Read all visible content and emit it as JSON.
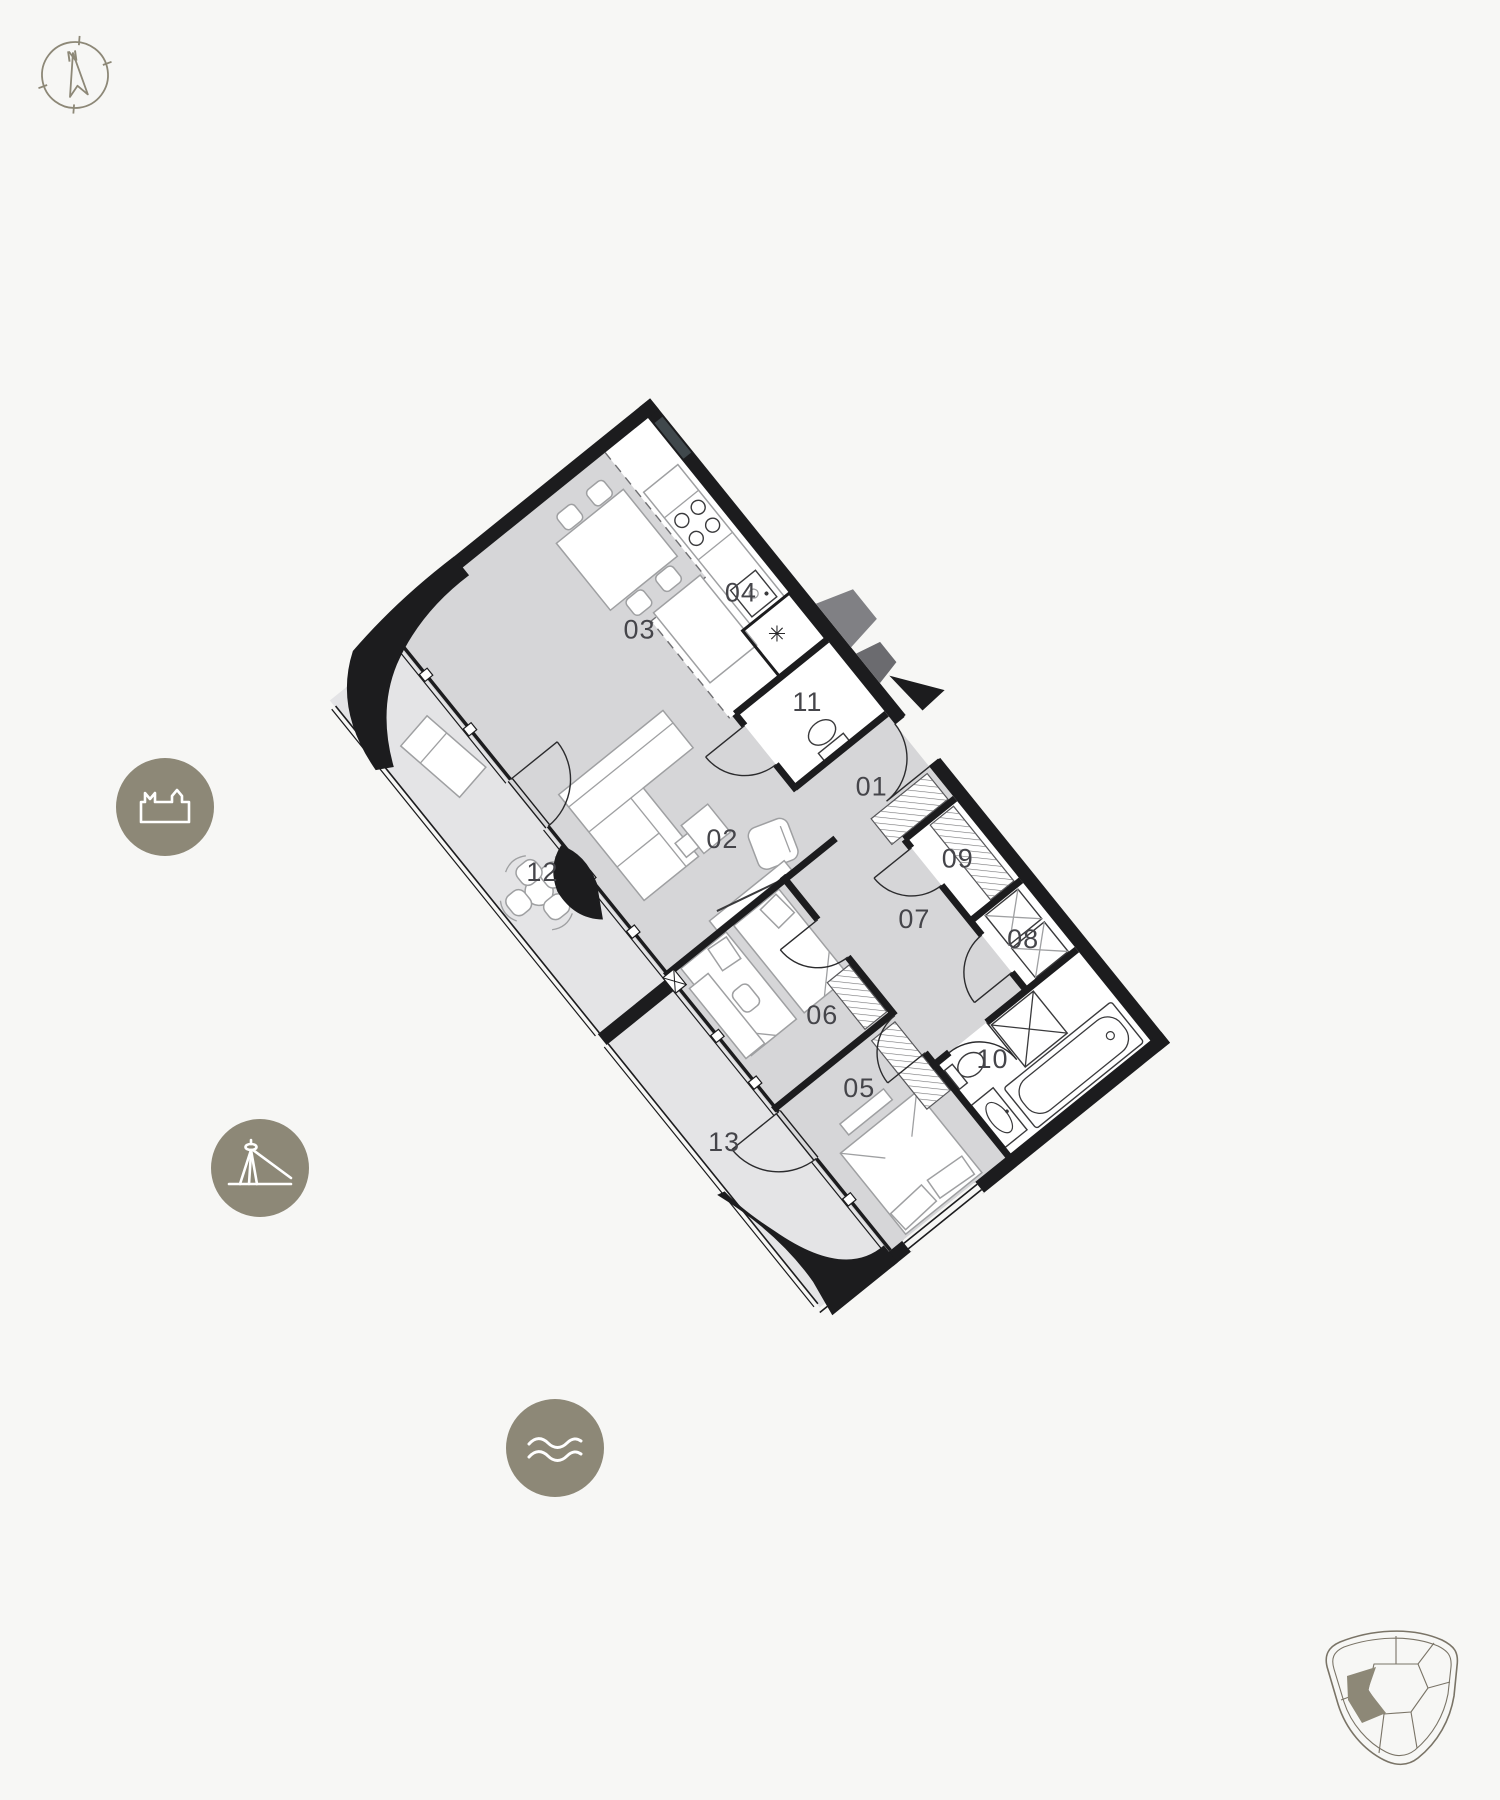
{
  "theme": {
    "background": "#f7f7f5",
    "badge_color": "#8d8877",
    "badge_icon_color": "#ffffff",
    "wall_color": "#1c1c1e",
    "floor_interior": "#d6d6d8",
    "floor_balcony": "#e4e4e6",
    "floor_wet_rooms": "#ffffff",
    "label_color": "#45454a",
    "outline_olive": "#7a7467"
  },
  "compass": {
    "north_label": "N"
  },
  "badges": [
    {
      "icon": "castle-icon"
    },
    {
      "icon": "bridge-icon"
    },
    {
      "icon": "waves-icon"
    }
  ],
  "plan": {
    "fridge_symbol": "✳",
    "rooms": [
      {
        "id": "room-01",
        "label": "01"
      },
      {
        "id": "room-02",
        "label": "02"
      },
      {
        "id": "room-03",
        "label": "03"
      },
      {
        "id": "room-04",
        "label": "04"
      },
      {
        "id": "room-05",
        "label": "05"
      },
      {
        "id": "room-06",
        "label": "06"
      },
      {
        "id": "room-07",
        "label": "07"
      },
      {
        "id": "room-08",
        "label": "08"
      },
      {
        "id": "room-09",
        "label": "09"
      },
      {
        "id": "room-10",
        "label": "10"
      },
      {
        "id": "room-11",
        "label": "11"
      },
      {
        "id": "room-12",
        "label": "12"
      },
      {
        "id": "room-13",
        "label": "13"
      }
    ]
  },
  "minimap": {
    "name": "building-overview",
    "highlighted_unit": "current-apartment"
  }
}
